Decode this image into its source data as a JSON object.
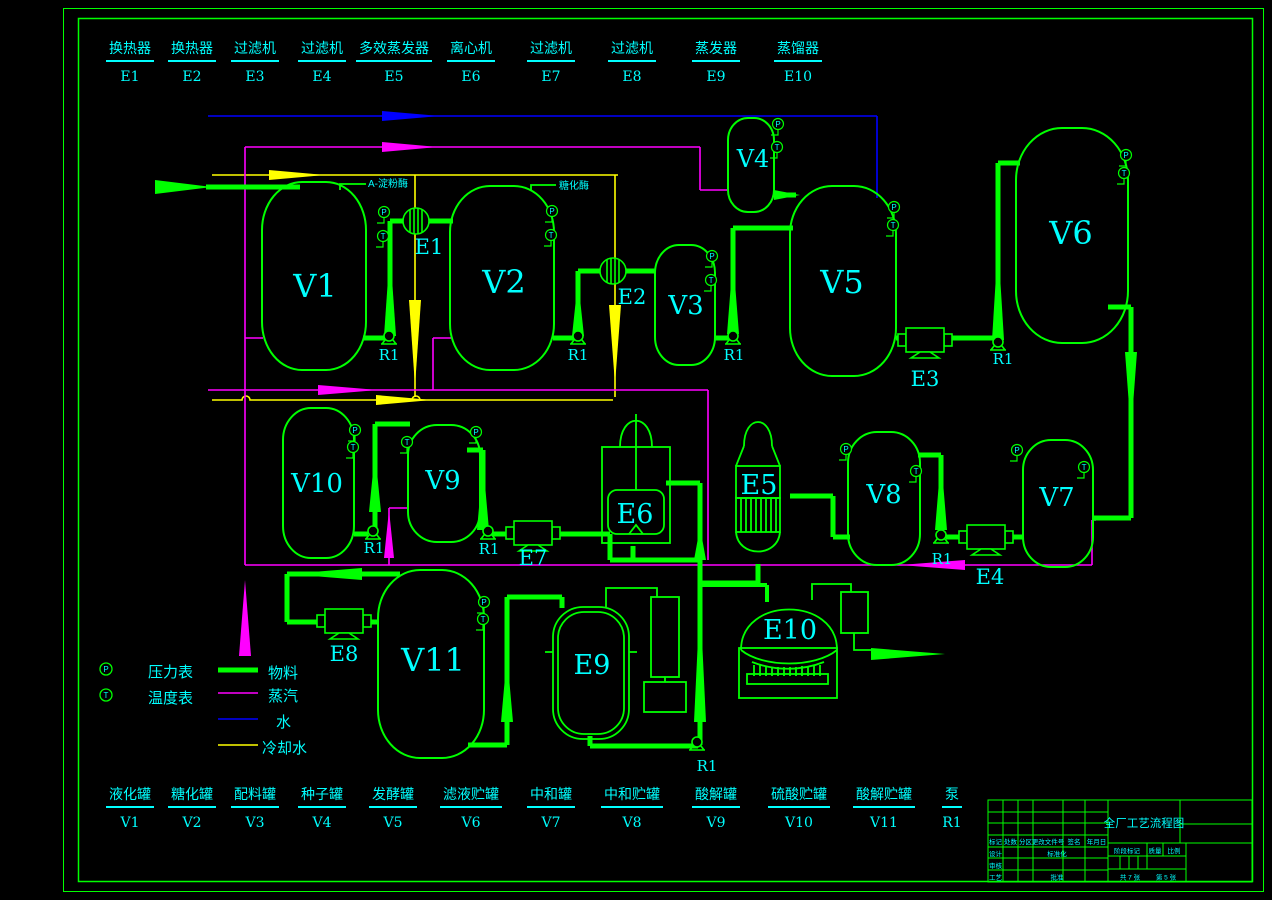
{
  "colors": {
    "material": "#00ff00",
    "steam": "#ff00ff",
    "water": "#0000ff",
    "cooling_water": "#ffff00",
    "label": "#00ffff"
  },
  "equipment_top": [
    {
      "name": "换热器",
      "code": "E1"
    },
    {
      "name": "换热器",
      "code": "E2"
    },
    {
      "name": "过滤机",
      "code": "E3"
    },
    {
      "name": "过滤机",
      "code": "E4"
    },
    {
      "name": "多效蒸发器",
      "code": "E5"
    },
    {
      "name": "离心机",
      "code": "E6"
    },
    {
      "name": "过滤机",
      "code": "E7"
    },
    {
      "name": "过滤机",
      "code": "E8"
    },
    {
      "name": "蒸发器",
      "code": "E9"
    },
    {
      "name": "蒸馏器",
      "code": "E10"
    }
  ],
  "equipment_bottom": [
    {
      "name": "液化罐",
      "code": "V1"
    },
    {
      "name": "糖化罐",
      "code": "V2"
    },
    {
      "name": "配料罐",
      "code": "V3"
    },
    {
      "name": "种子罐",
      "code": "V4"
    },
    {
      "name": "发酵罐",
      "code": "V5"
    },
    {
      "name": "滤液贮罐",
      "code": "V6"
    },
    {
      "name": "中和罐",
      "code": "V7"
    },
    {
      "name": "中和贮罐",
      "code": "V8"
    },
    {
      "name": "酸解罐",
      "code": "V9"
    },
    {
      "name": "硫酸贮罐",
      "code": "V10"
    },
    {
      "name": "酸解贮罐",
      "code": "V11"
    },
    {
      "name": "泵",
      "code": "R1"
    }
  ],
  "vessels": {
    "v1": "V1",
    "v2": "V2",
    "v3": "V3",
    "v4": "V4",
    "v5": "V5",
    "v6": "V6",
    "v7": "V7",
    "v8": "V8",
    "v9": "V9",
    "v10": "V10",
    "v11": "V11"
  },
  "units": {
    "e1": "E1",
    "e2": "E2",
    "e3": "E3",
    "e4": "E4",
    "e5": "E5",
    "e6": "E6",
    "e7": "E7",
    "e8": "E8",
    "e9": "E9",
    "e10": "E10"
  },
  "pump_label": "R1",
  "annotations": {
    "alpha_amylase": "Α-淀粉酶",
    "glucoamylase": "糖化酶"
  },
  "legend": {
    "gauges": [
      {
        "symbol": "P",
        "label": "压力表"
      },
      {
        "symbol": "T",
        "label": "温度表"
      }
    ],
    "lines": [
      {
        "label": "物料"
      },
      {
        "label": "蒸汽"
      },
      {
        "label": "水"
      },
      {
        "label": "冷却水"
      }
    ]
  },
  "title_block": {
    "title": "全厂工艺流程图",
    "headers": [
      "标记",
      "处数",
      "分区",
      "更改文件号",
      "签名",
      "年月日"
    ],
    "design": "设计",
    "standardize": "标准化",
    "review": "审核",
    "process": "工艺",
    "approve": "批准",
    "stage": "阶段标记",
    "weight": "质量",
    "scale": "比例",
    "sheets_total": "共 7 张",
    "sheet_no": "第 5 张"
  }
}
